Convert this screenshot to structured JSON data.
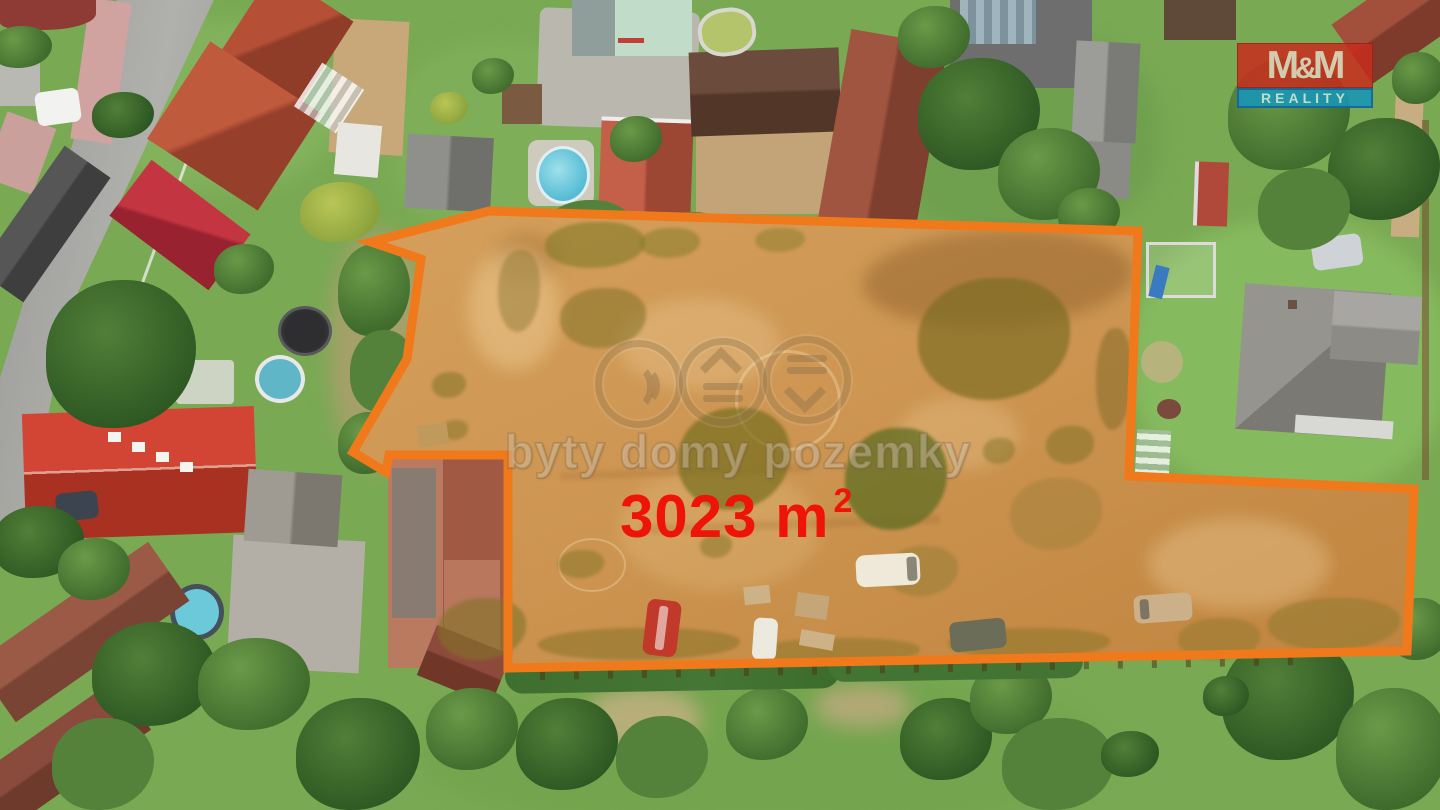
{
  "plot": {
    "area_value": "3023 m",
    "area_superscript": "2",
    "area_text_color": "#ee1408",
    "outline_color": "#f0791c",
    "fill_light": "#d5a05c",
    "fill_dark": "#c0843e",
    "outline_points": "489,211 1138,231 1129,476 1414,489 1407,651 508,668 508,455 389,455 386,472 353,452 407,359 421,259 371,242"
  },
  "watermark": {
    "text": "byty domy pozemky"
  },
  "logo": {
    "m1": "M",
    "amp": "&",
    "m2": "M",
    "line2": "REALITY"
  }
}
